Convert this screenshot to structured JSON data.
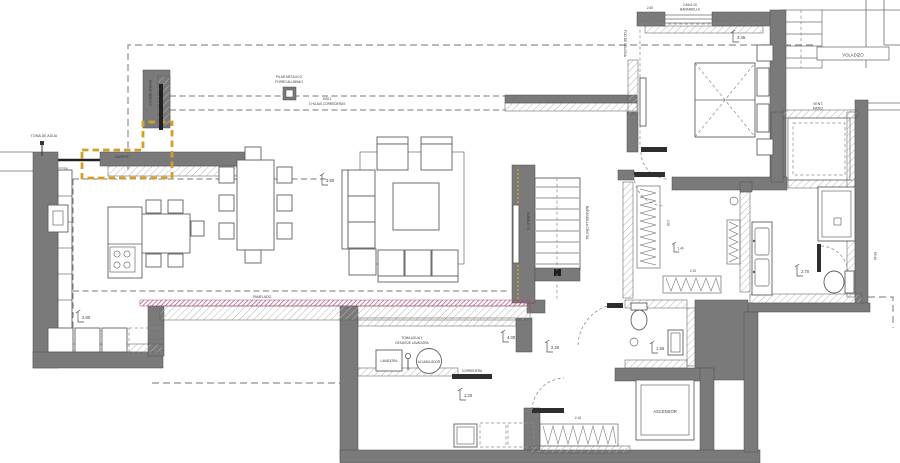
{
  "drawing": {
    "type": "architectural-floor-plan",
    "labels": {
      "voladizo": "VOLADIZO",
      "toma_agua": "TOMA DE AGUA",
      "pilar_1": "PILAR METALICO",
      "pilar_2": "FORRO ALUMINIO",
      "puerta_1": "HS01",
      "puerta_2": "3 HOJAS CORREDERAS",
      "murete": "MURETE",
      "revestimiento": "REVESTIMIENTO",
      "panelado": "PANELADO",
      "mueble_tv": "MUEBLE TV",
      "barandilla_cristal": "BARANDILLA CRISTAL",
      "fijo_celosia": "FIJO DE CELOSIA",
      "ventana_1": "2.60",
      "ventana_2": "2.84x1.00",
      "ventana_3": "BARANDILLA",
      "vent_patio_1": "VENT.",
      "vent_patio_2": "PATIO",
      "ascensor": "ASCENSOR",
      "lavadora": "LAVADORA",
      "acumulador": "ACUMULADOR",
      "inst_1": "TOMA AGUA Y",
      "inst_2": "DESAGÜE LAVADORA",
      "corredera": "CORREDERA"
    },
    "dimensions": {
      "salon": "3.50",
      "cocina": "2.80",
      "lavadero": "4.00",
      "distribuidor": "2.20",
      "entrada": "1.20",
      "dormitorio": "3.45",
      "bano": "2.70",
      "aseo": "1.65",
      "vestidor_ancho": "2.50",
      "vestidor_fondo": "1.40",
      "vestidor_largo": "2.10",
      "armario": "2.16",
      "lateral": "65.46"
    },
    "colors": {
      "wall": "#7a7a7a",
      "line": "#606060",
      "dashed": "#8f8f8f",
      "highlight_yellow": "#d2a02a",
      "highlight_magenta": "#a84c7f",
      "text": "#3c3c3c",
      "door": "#2e2e2e"
    }
  }
}
